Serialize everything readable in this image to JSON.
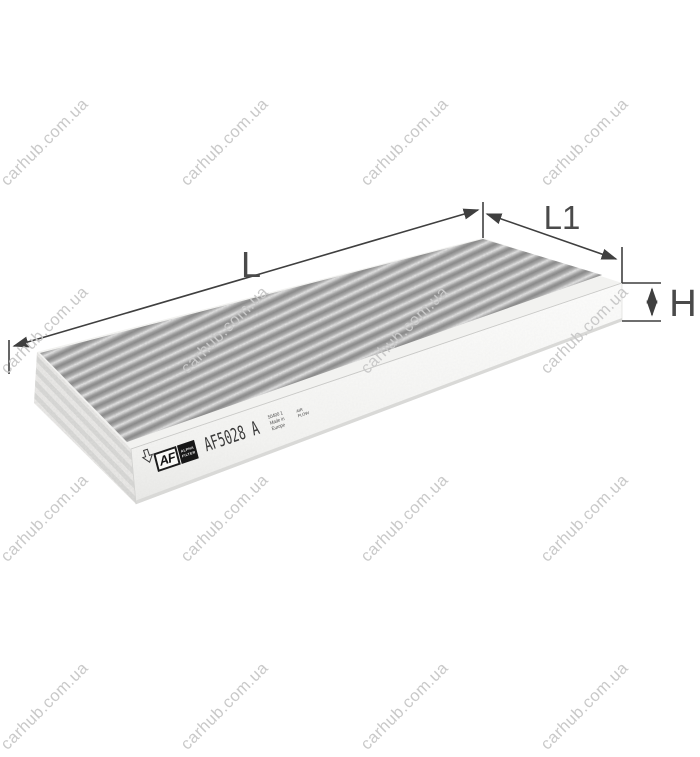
{
  "watermark": {
    "text": "carhub.com.ua",
    "color": "#c9c9c9"
  },
  "dimensions": {
    "length_label": "L",
    "depth_label": "L1",
    "height_label": "H",
    "line_color": "#3f3f3f",
    "text_color": "#4a4a4a"
  },
  "label": {
    "brand_abbrev": "AF",
    "brand_sub_line1": "ALPHA",
    "brand_sub_line2": "FILTER",
    "part_number": "AF5028 A",
    "info_line1": "50400 1",
    "info_line2": "Made in",
    "info_line3": "Europe",
    "airflow_line1": "AIR",
    "airflow_line2": "FLOW"
  },
  "product": {
    "type": "activated-carbon cabin air filter",
    "media_color": "#9a9a9a",
    "frame_color": "#f4f4f2"
  }
}
